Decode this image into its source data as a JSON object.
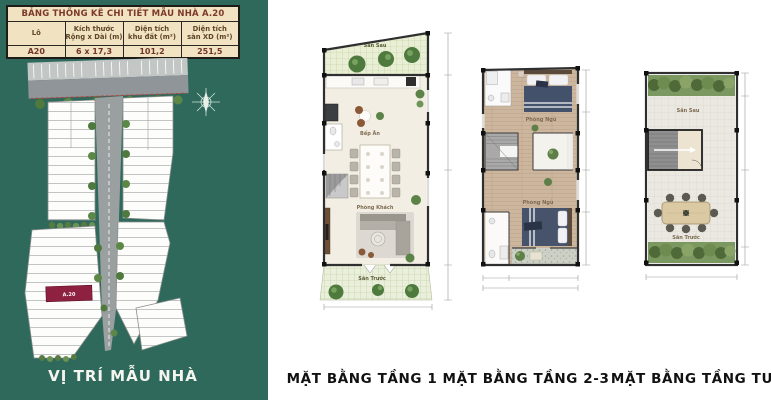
{
  "colors": {
    "panel_bg": "#2f695c",
    "highlight_lot": "#8e2040",
    "table_bg": "#f1e2c2"
  },
  "panel": {
    "table": {
      "title": "BẢNG THỐNG KÊ CHI TIẾT MẪU NHÀ A.20",
      "headers": [
        {
          "line1": "Lô",
          "line2": ""
        },
        {
          "line1": "Kích thước",
          "line2": "Rộng x Dài (m)"
        },
        {
          "line1": "Diện tích",
          "line2": "khu đất (m²)"
        },
        {
          "line1": "Diện tích",
          "line2": "sàn XD (m²)"
        }
      ],
      "row": [
        "A20",
        "6 x 17,3",
        "101,2",
        "251,5"
      ]
    },
    "site": {
      "highlight_label": "A.20"
    },
    "caption": "VỊ TRÍ MẪU NHÀ"
  },
  "plans": [
    {
      "caption": "MẶT BẰNG TẦNG 1",
      "labels": {
        "back_yard": "Sân Sau",
        "kitchen": "Bếp Ăn",
        "living": "Phòng Khách",
        "front_yard": "Sân Trước"
      }
    },
    {
      "caption": "MẶT BẰNG TẦNG 2-3",
      "labels": {
        "bedroom_top": "Phòng Ngủ",
        "bedroom_bottom": "Phòng Ngủ"
      }
    },
    {
      "caption": "MẶT BẰNG TẦNG TUM",
      "labels": {
        "back_yard": "Sân Sau",
        "front_yard": "Sân Trước"
      }
    }
  ]
}
